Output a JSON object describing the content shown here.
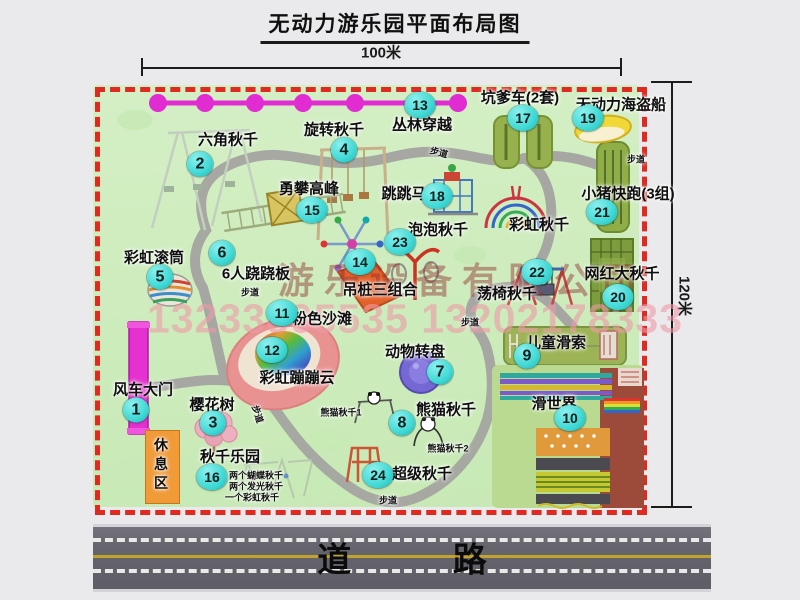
{
  "title": "无动力游乐园平面布局图",
  "dimensions": {
    "width_label": "100米",
    "height_label": "120米"
  },
  "road": {
    "label": "道 路"
  },
  "watermark": {
    "company": "游乐设备有限公司",
    "phone": "13233805535 13202178333"
  },
  "colors": {
    "marker": "#3ed8d4",
    "map_green": "#cdecba",
    "border_red": "#de2a20",
    "gate_magenta": "#e531cf",
    "zipline_magenta": "#e02cd0",
    "path_gray": "#a3a2a0",
    "road_gray": "#66656d",
    "road_yellow": "#c2a22e",
    "rest_orange": "#f09a38",
    "watermark_dark": "#8f2f2f",
    "watermark_pink": "#ef9aa8"
  },
  "map": {
    "attractions": [
      {
        "num": "1",
        "name": "风车大门",
        "cx": 136,
        "cy": 410,
        "lx": 143,
        "ly": 389
      },
      {
        "num": "2",
        "name": "六角秋千",
        "cx": 200,
        "cy": 164,
        "lx": 228,
        "ly": 139
      },
      {
        "num": "3",
        "name": "樱花树",
        "cx": 213,
        "cy": 423,
        "lx": 212,
        "ly": 404
      },
      {
        "num": "4",
        "name": "旋转秋千",
        "cx": 344,
        "cy": 150,
        "lx": 334,
        "ly": 129
      },
      {
        "num": "5",
        "name": "彩虹滚筒",
        "cx": 160,
        "cy": 277,
        "lx": 154,
        "ly": 257
      },
      {
        "num": "6",
        "name": "6人跷跷板",
        "cx": 222,
        "cy": 253,
        "lx": 256,
        "ly": 273
      },
      {
        "num": "7",
        "name": "动物转盘",
        "cx": 440,
        "cy": 372,
        "lx": 415,
        "ly": 351
      },
      {
        "num": "8",
        "name": "熊猫秋千",
        "cx": 402,
        "cy": 423,
        "lx": 446,
        "ly": 409
      },
      {
        "num": "9",
        "name": "儿童滑索",
        "cx": 527,
        "cy": 356,
        "lx": 556,
        "ly": 342
      },
      {
        "num": "10",
        "name": "滑世界",
        "cx": 570,
        "cy": 418,
        "lx": 554,
        "ly": 403
      },
      {
        "num": "11",
        "name": "粉色沙滩",
        "cx": 282,
        "cy": 313,
        "lx": 322,
        "ly": 318
      },
      {
        "num": "12",
        "name": "彩虹蹦蹦云",
        "cx": 272,
        "cy": 350,
        "lx": 297,
        "ly": 377
      },
      {
        "num": "13",
        "name": "丛林穿越",
        "cx": 420,
        "cy": 105,
        "lx": 422,
        "ly": 124
      },
      {
        "num": "14",
        "name": "吊桩三组合",
        "cx": 360,
        "cy": 262,
        "lx": 380,
        "ly": 289
      },
      {
        "num": "15",
        "name": "勇攀高峰",
        "cx": 312,
        "cy": 210,
        "lx": 309,
        "ly": 188
      },
      {
        "num": "16",
        "name": "秋千乐园",
        "cx": 212,
        "cy": 477,
        "lx": 230,
        "ly": 456
      },
      {
        "num": "17",
        "name": "坑爹车(2套)",
        "cx": 523,
        "cy": 118,
        "lx": 520,
        "ly": 97
      },
      {
        "num": "18",
        "name": "跳跳马",
        "cx": 437,
        "cy": 196,
        "lx": 404,
        "ly": 193
      },
      {
        "num": "19",
        "name": "无动力海盗船",
        "cx": 588,
        "cy": 118,
        "lx": 621,
        "ly": 104
      },
      {
        "num": "20",
        "name": "网红大秋千",
        "cx": 618,
        "cy": 297,
        "lx": 622,
        "ly": 273
      },
      {
        "num": "21",
        "name": "小猪快跑(3组)",
        "cx": 602,
        "cy": 212,
        "lx": 628,
        "ly": 193
      },
      {
        "num": "22",
        "name": "荡椅秋千",
        "cx": 537,
        "cy": 272,
        "lx": 507,
        "ly": 293
      },
      {
        "num": "23",
        "name": "泡泡秋千",
        "cx": 400,
        "cy": 242,
        "lx": 438,
        "ly": 229
      },
      {
        "num": "24",
        "name": "超级秋千",
        "cx": 378,
        "cy": 475,
        "lx": 422,
        "ly": 473
      }
    ],
    "extra_labels": [
      {
        "text": "彩虹秋千",
        "x": 539,
        "y": 224,
        "fs": 15
      },
      {
        "text": "休息区",
        "x": 161,
        "y": 466,
        "fs": 14,
        "vertical": true
      },
      {
        "text": "熊猫秋千1",
        "x": 341,
        "y": 412,
        "fs": 9
      },
      {
        "text": "熊猫秋千2",
        "x": 448,
        "y": 448,
        "fs": 9
      },
      {
        "text": "两个蝴蝶秋千",
        "x": 256,
        "y": 475,
        "fs": 9
      },
      {
        "text": "两个发光秋千",
        "x": 256,
        "y": 486,
        "fs": 9
      },
      {
        "text": "一个彩虹秋千",
        "x": 252,
        "y": 497,
        "fs": 9
      },
      {
        "text": "步道",
        "x": 439,
        "y": 152,
        "fs": 9,
        "rot": 15
      },
      {
        "text": "步道",
        "x": 636,
        "y": 159,
        "fs": 9
      },
      {
        "text": "步道",
        "x": 250,
        "y": 292,
        "fs": 9
      },
      {
        "text": "步道",
        "x": 470,
        "y": 322,
        "fs": 9
      },
      {
        "text": "步道",
        "x": 258,
        "y": 414,
        "fs": 9,
        "rot": 72
      },
      {
        "text": "步道",
        "x": 388,
        "y": 500,
        "fs": 9
      }
    ]
  }
}
